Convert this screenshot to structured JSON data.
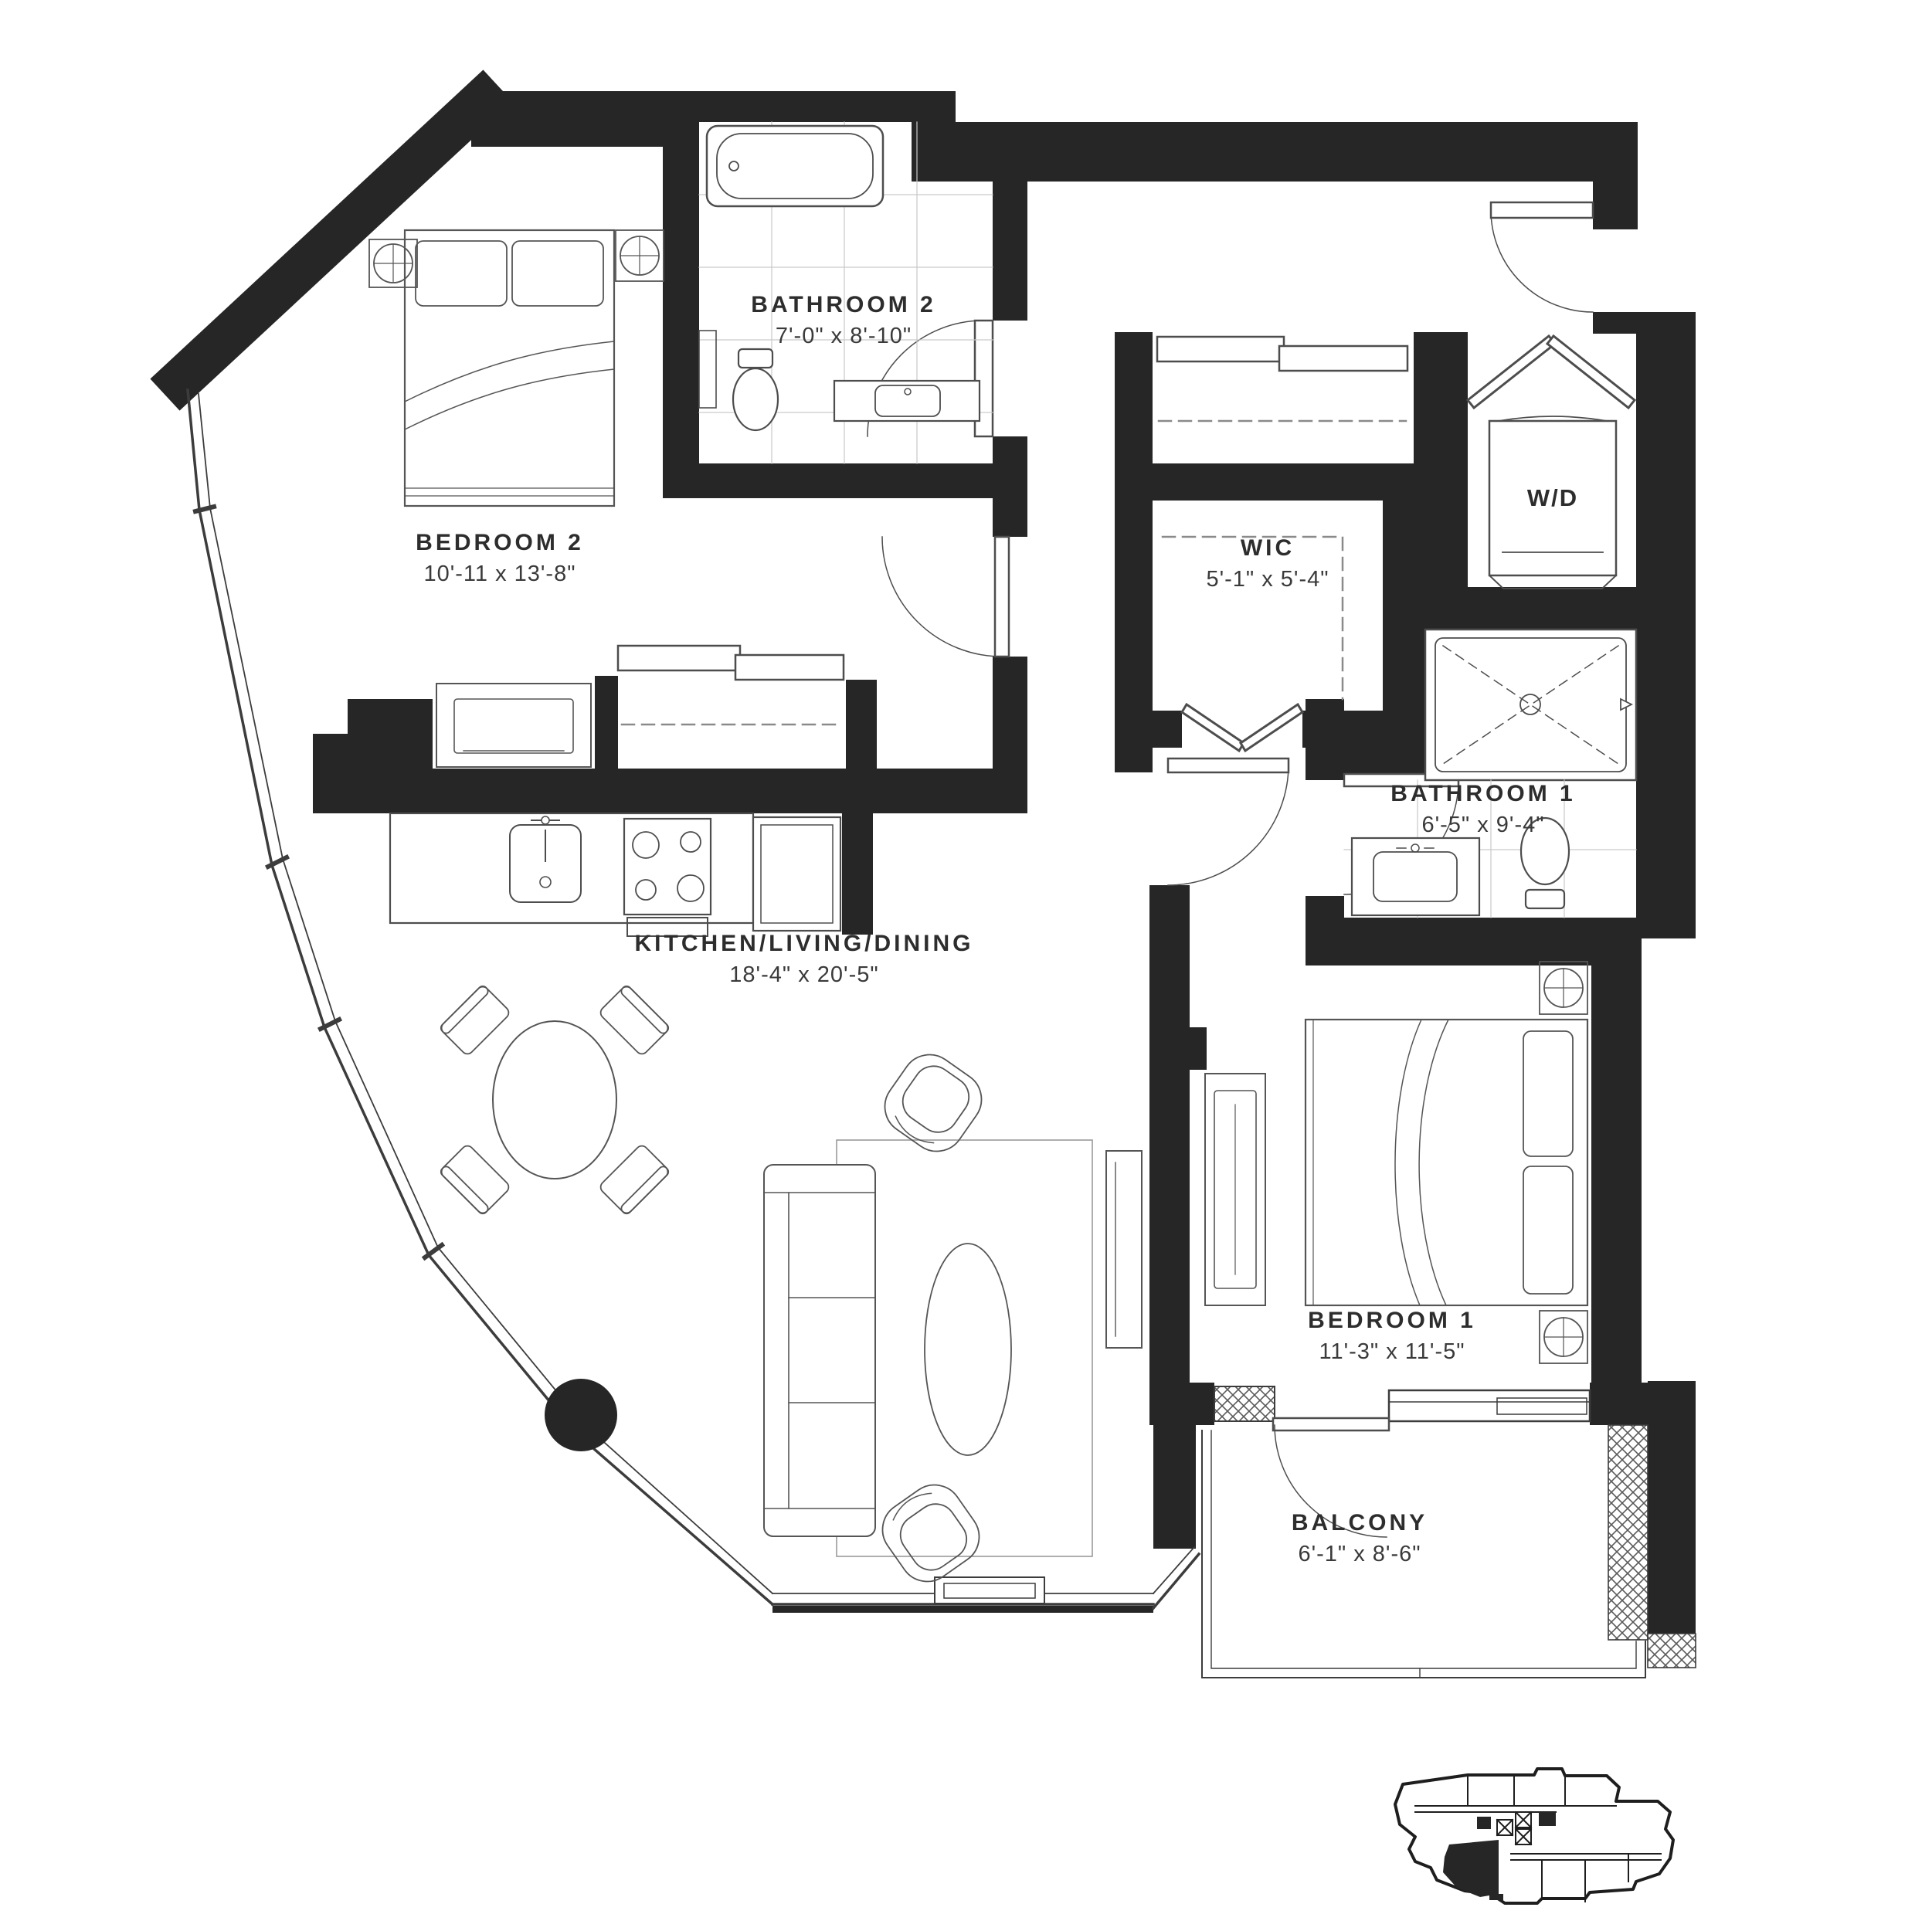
{
  "page": {
    "type": "architectural-floor-plan"
  },
  "floorplan": {
    "rooms": [
      {
        "id": "bedroom-2",
        "name": "BEDROOM 2",
        "dims": "10'-11 x 13'-8\""
      },
      {
        "id": "bathroom-2",
        "name": "BATHROOM 2",
        "dims": "7'-0\" x 8'-10\""
      },
      {
        "id": "wic",
        "name": "WIC",
        "dims": "5'-1\" x 5'-4\""
      },
      {
        "id": "bathroom-1",
        "name": "BATHROOM 1",
        "dims": "6'-5\" x 9'-4\""
      },
      {
        "id": "kitchen-living-dining",
        "name": "KITCHEN/LIVING/DINING",
        "dims": "18'-4\" x 20'-5\""
      },
      {
        "id": "bedroom-1",
        "name": "BEDROOM 1",
        "dims": "11'-3\" x 11'-5\""
      },
      {
        "id": "balcony",
        "name": "BALCONY",
        "dims": "6'-1\" x 8'-6\""
      }
    ],
    "appliances": {
      "washer_dryer": "W/D"
    },
    "colors": {
      "wall": "#262626",
      "line": "#4d4d4d",
      "light_line": "#9a9a9a",
      "background": "#ffffff"
    },
    "fixtures": [
      "bathtub",
      "toilet",
      "vanity-sink",
      "shower",
      "washer-dryer",
      "refrigerator",
      "range",
      "kitchen-sink",
      "bed",
      "nightstand",
      "dresser",
      "sofa",
      "armchair",
      "coffee-table",
      "dining-table",
      "dining-chair",
      "structural-column",
      "rug",
      "balcony-railing",
      "key-plan"
    ]
  }
}
